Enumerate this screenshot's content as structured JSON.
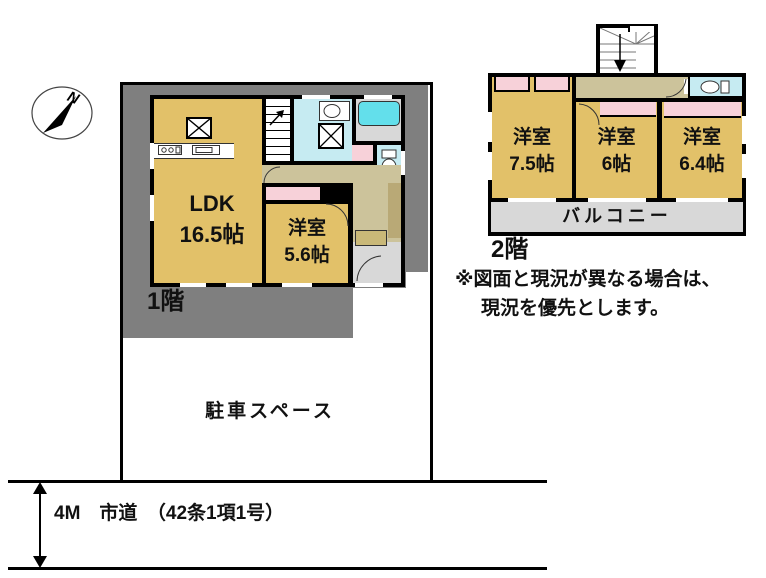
{
  "compass": {
    "label": "N"
  },
  "floor1": {
    "label": "1階",
    "ldk": {
      "name": "LDK",
      "size": "16.5帖"
    },
    "room": {
      "name": "洋室",
      "size": "5.6帖"
    }
  },
  "floor2": {
    "label": "2階",
    "rooms": [
      {
        "name": "洋室",
        "size": "7.5帖"
      },
      {
        "name": "洋室",
        "size": "6帖"
      },
      {
        "name": "洋室",
        "size": "6.4帖"
      }
    ],
    "balcony": "バルコニー"
  },
  "site": {
    "parking": "駐車スペース",
    "road": "4M　市道　（42条1項1号）"
  },
  "note": {
    "line1": "※図面と現況が異なる場合は、",
    "line2": "現況を優先とします。"
  },
  "colors": {
    "room": "#e2c169",
    "closet": "#f7d1d9",
    "wet": "#c6ebf2",
    "bath": "#63dfeb",
    "hall": "#ccc39b",
    "plot": "#7f7f7f",
    "balcony": "#d8d8d8",
    "step": "#c9b878",
    "cabinet": "#b9a976"
  }
}
